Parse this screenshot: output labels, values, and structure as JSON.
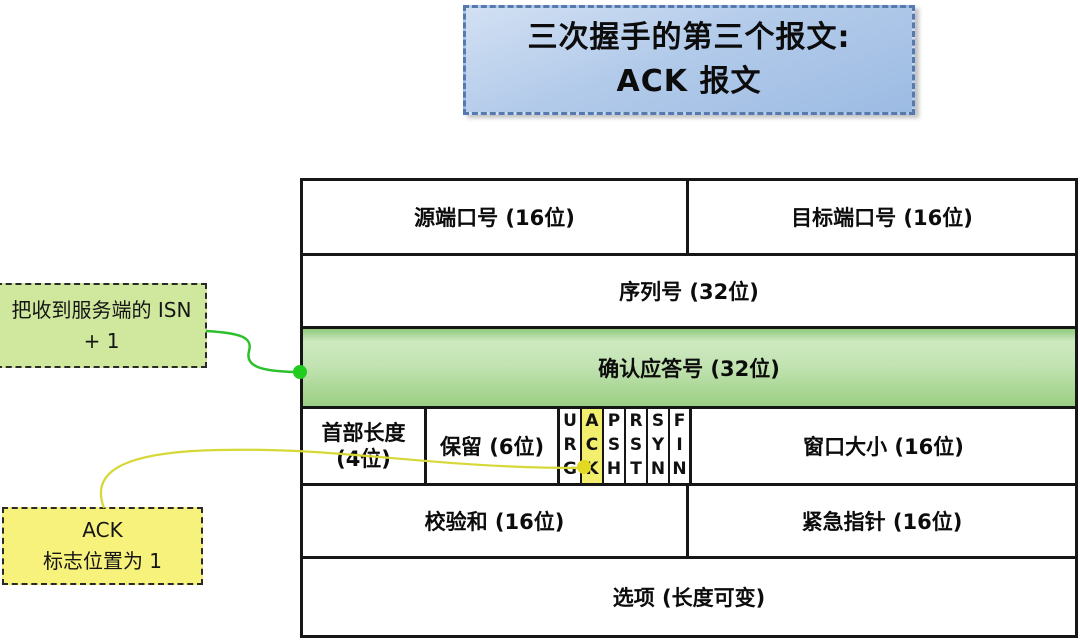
{
  "title": {
    "line1": "三次握手的第三个报文:",
    "line2": "ACK 报文"
  },
  "notes": {
    "isn_note": {
      "line1": "把收到服务端的 ISN",
      "line2": "+ 1"
    },
    "ack_note": {
      "line1": "ACK",
      "line2": "标志位置为 1"
    }
  },
  "tcp_header": {
    "source_port": "源端口号 (16位)",
    "dest_port": "目标端口号 (16位)",
    "sequence": "序列号 (32位)",
    "ack_number": "确认应答号 (32位)",
    "header_length_line1": "首部长度",
    "header_length_line2": "(4位)",
    "reserved": "保留 (6位)",
    "flags": [
      "URG",
      "ACK",
      "PSH",
      "RST",
      "SYN",
      "FIN"
    ],
    "highlighted_flag": "ACK",
    "window_size": "窗口大小 (16位)",
    "checksum": "校验和 (16位)",
    "urgent_pointer": "紧急指针 (16位)",
    "options": "选项 (长度可变)"
  },
  "colors": {
    "title_border": "#5679ae",
    "title_bg_top": "#d2e0f3",
    "title_bg_bottom": "#9cbbe3",
    "ack_row_green_light": "#cde9c0",
    "ack_row_green_dark": "#9bcf83",
    "isn_note_bg": "#cfe89e",
    "ack_note_bg": "#f6f27c",
    "ack_flag_highlight": "#f2ee6e",
    "connector_green": "#2dc02d",
    "connector_green_dot": "#1fcc1f",
    "connector_yellow": "#d6d838",
    "connector_yellow_dot": "#e3d822"
  }
}
